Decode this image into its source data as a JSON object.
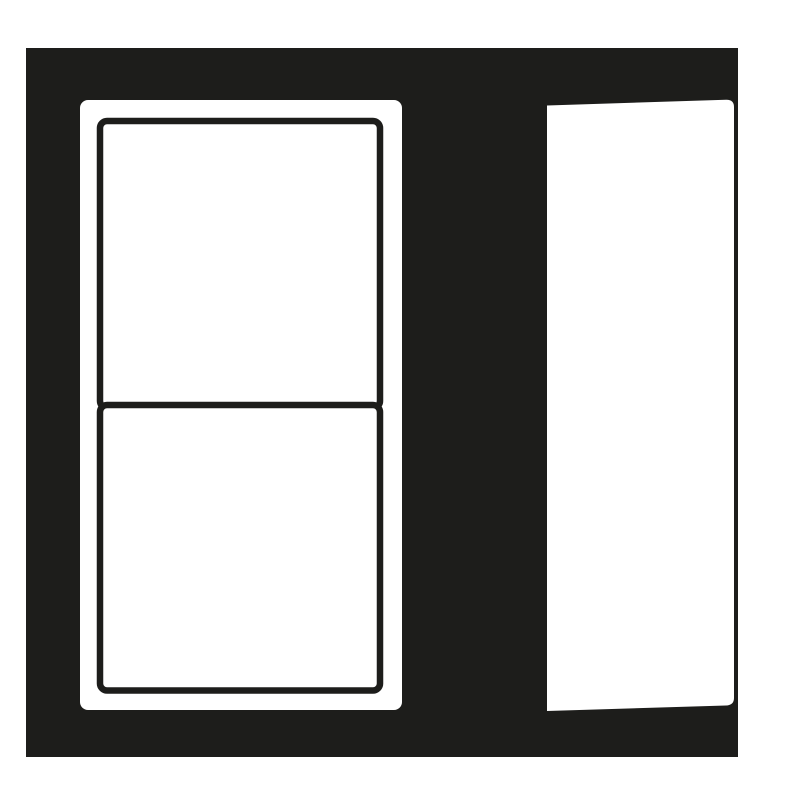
{
  "pictogram": {
    "colors": {
      "ink": "#1d1d1b",
      "paper": "#ffffff"
    },
    "icons": [
      {
        "name": "two-pane-window-icon"
      },
      {
        "name": "open-door-icon"
      }
    ]
  }
}
